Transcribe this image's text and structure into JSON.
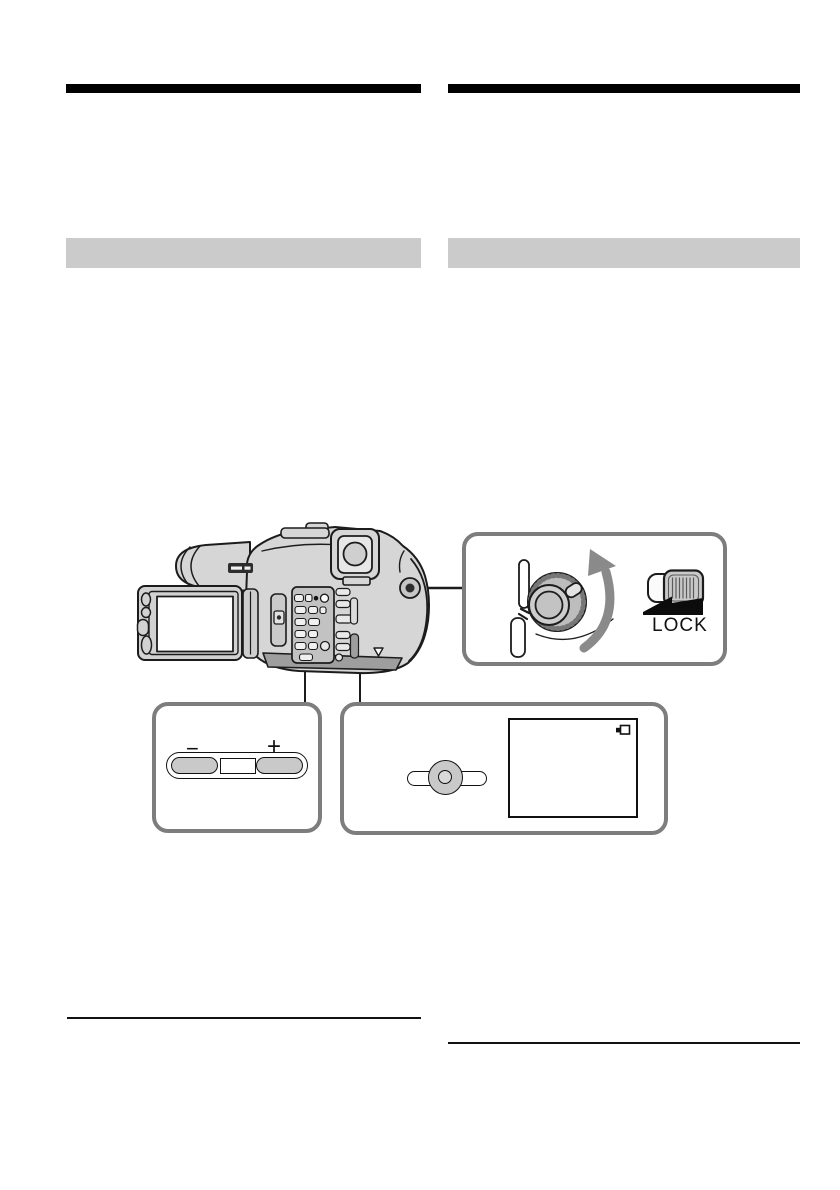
{
  "labels": {
    "lock": "LOCK",
    "minus": "−",
    "plus": "+"
  },
  "colors": {
    "title_bar_black": "#000000",
    "section_bar_gray": "#cbcbcb",
    "callout_border_gray": "#7d7d7d",
    "illustration_stroke": "#1c1c1c",
    "illustration_fill": "#d6d6d6",
    "rotate_arrow_gray": "#8a8a8a",
    "button_fill_gray": "#c9c9c9"
  },
  "icons": {
    "rotate_arrow": "curved-rotate-arrow-icon",
    "lock_wedge": "lock-direction-wedge-icon",
    "screen_status": "battery-icon"
  }
}
